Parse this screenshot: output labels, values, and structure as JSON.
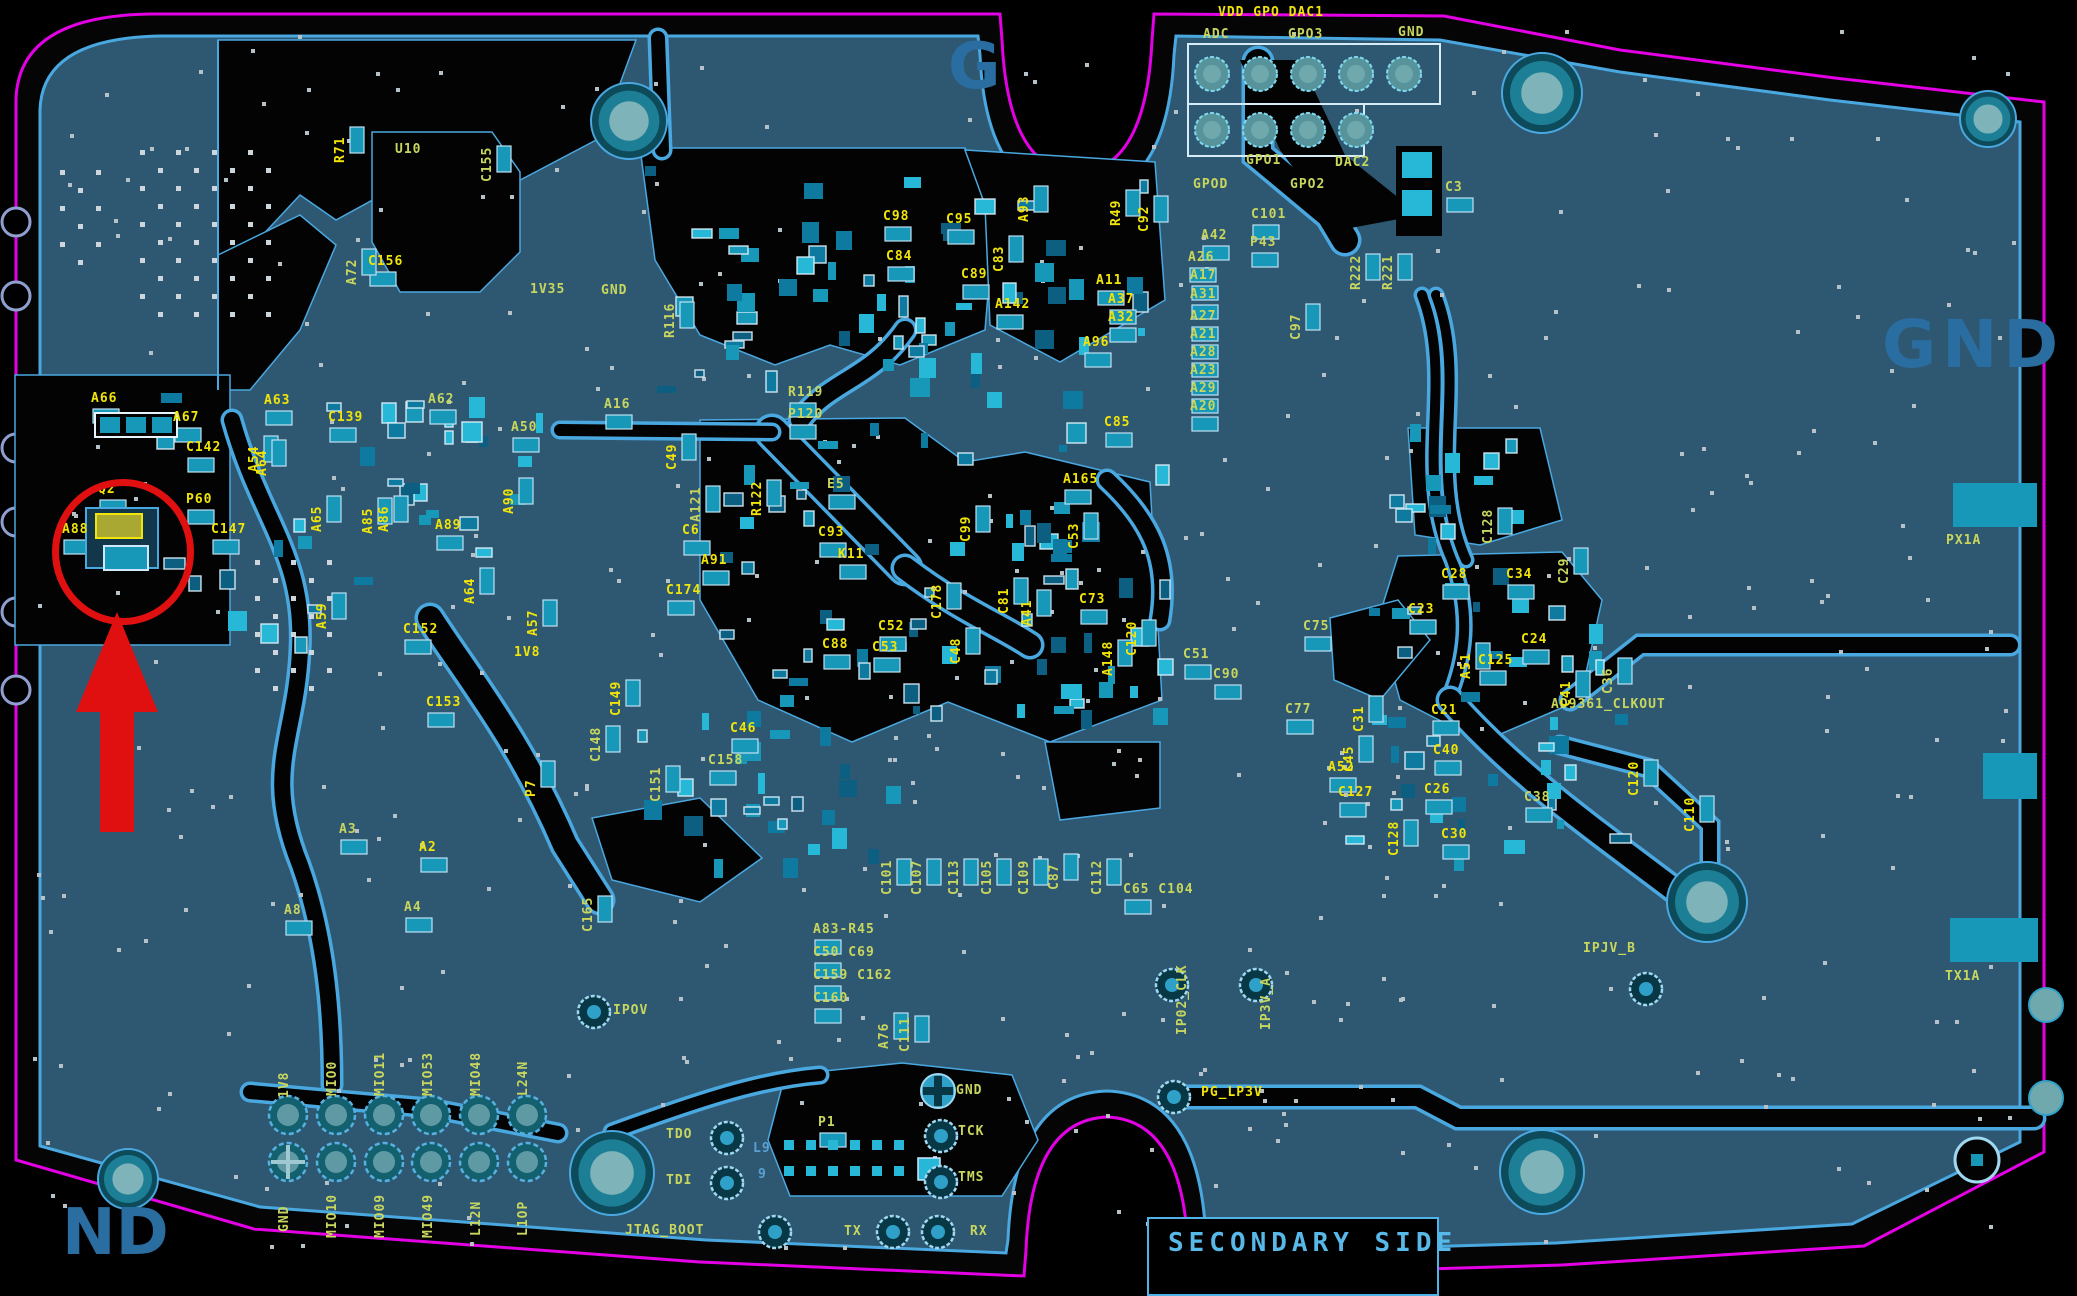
{
  "big_texts": {
    "g_top": "G",
    "gnd_right": "GND",
    "nd_bottom_left": "ND",
    "secondary_side": "SECONDARY SIDE"
  },
  "colors": {
    "board": "#2e5872",
    "outline_magenta": "#e400e4",
    "edge_blue": "#4aa8e0",
    "silk_green": "#c9d65e",
    "silk_yellow": "#f0e40a",
    "big_text_blue": "#2a6da0",
    "pad_teal": "#1898b8",
    "highlight_red": "#e01010"
  },
  "labels": [
    {
      "t": "VDD GPO DAC1",
      "x": 1218,
      "y": 6,
      "o": "h",
      "c": "y"
    },
    {
      "t": "ADC",
      "x": 1203,
      "y": 28,
      "o": "h",
      "c": "g"
    },
    {
      "t": "GPO3",
      "x": 1288,
      "y": 28,
      "o": "h",
      "c": "g"
    },
    {
      "t": "GND",
      "x": 1398,
      "y": 26,
      "o": "h",
      "c": "g"
    },
    {
      "t": "GPO1",
      "x": 1246,
      "y": 154,
      "o": "h",
      "c": "g"
    },
    {
      "t": "DAC2",
      "x": 1335,
      "y": 156,
      "o": "h",
      "c": "g"
    },
    {
      "t": "GPOD",
      "x": 1193,
      "y": 178,
      "o": "h",
      "c": "g"
    },
    {
      "t": "GPO2",
      "x": 1290,
      "y": 178,
      "o": "h",
      "c": "g"
    },
    {
      "t": "C3",
      "x": 1445,
      "y": 181,
      "o": "h",
      "c": "g"
    },
    {
      "t": "C101",
      "x": 1251,
      "y": 208,
      "o": "h",
      "c": "g"
    },
    {
      "t": "A42",
      "x": 1201,
      "y": 229,
      "o": "h",
      "c": "g"
    },
    {
      "t": "P43",
      "x": 1250,
      "y": 236,
      "o": "h",
      "c": "g"
    },
    {
      "t": "A26",
      "x": 1188,
      "y": 251,
      "o": "h",
      "c": "g"
    },
    {
      "t": "A17",
      "x": 1190,
      "y": 269,
      "o": "h",
      "c": "g"
    },
    {
      "t": "A31",
      "x": 1190,
      "y": 288,
      "o": "h",
      "c": "g"
    },
    {
      "t": "A27",
      "x": 1190,
      "y": 310,
      "o": "h",
      "c": "g"
    },
    {
      "t": "A21",
      "x": 1190,
      "y": 328,
      "o": "h",
      "c": "g"
    },
    {
      "t": "A28",
      "x": 1190,
      "y": 346,
      "o": "h",
      "c": "g"
    },
    {
      "t": "A23",
      "x": 1190,
      "y": 364,
      "o": "h",
      "c": "g"
    },
    {
      "t": "A29",
      "x": 1190,
      "y": 382,
      "o": "h",
      "c": "g"
    },
    {
      "t": "A20",
      "x": 1190,
      "y": 400,
      "o": "h",
      "c": "g"
    },
    {
      "t": "C98",
      "x": 883,
      "y": 210,
      "o": "h",
      "c": "y"
    },
    {
      "t": "C95",
      "x": 946,
      "y": 213,
      "o": "h",
      "c": "y"
    },
    {
      "t": "C84",
      "x": 886,
      "y": 250,
      "o": "h",
      "c": "y"
    },
    {
      "t": "C89",
      "x": 961,
      "y": 268,
      "o": "h",
      "c": "y"
    },
    {
      "t": "A142",
      "x": 995,
      "y": 298,
      "o": "h",
      "c": "y"
    },
    {
      "t": "A11",
      "x": 1096,
      "y": 274,
      "o": "h",
      "c": "y"
    },
    {
      "t": "A37",
      "x": 1108,
      "y": 293,
      "o": "h",
      "c": "y"
    },
    {
      "t": "A32",
      "x": 1108,
      "y": 311,
      "o": "h",
      "c": "y"
    },
    {
      "t": "A96",
      "x": 1083,
      "y": 336,
      "o": "h",
      "c": "y"
    },
    {
      "t": "C85",
      "x": 1104,
      "y": 416,
      "o": "h",
      "c": "y"
    },
    {
      "t": "1V35",
      "x": 530,
      "y": 283,
      "o": "h",
      "c": "g"
    },
    {
      "t": "GND",
      "x": 601,
      "y": 284,
      "o": "h",
      "c": "g"
    },
    {
      "t": "A16",
      "x": 604,
      "y": 398,
      "o": "h",
      "c": "g"
    },
    {
      "t": "R119",
      "x": 788,
      "y": 386,
      "o": "h",
      "c": "g"
    },
    {
      "t": "P120",
      "x": 788,
      "y": 408,
      "o": "h",
      "c": "g"
    },
    {
      "t": "A50",
      "x": 511,
      "y": 421,
      "o": "h",
      "c": "g"
    },
    {
      "t": "C139",
      "x": 328,
      "y": 411,
      "o": "h",
      "c": "y"
    },
    {
      "t": "A62",
      "x": 428,
      "y": 393,
      "o": "h",
      "c": "g"
    },
    {
      "t": "A63",
      "x": 264,
      "y": 394,
      "o": "h",
      "c": "y"
    },
    {
      "t": "A66",
      "x": 91,
      "y": 392,
      "o": "h",
      "c": "y"
    },
    {
      "t": "A67",
      "x": 173,
      "y": 411,
      "o": "h",
      "c": "y"
    },
    {
      "t": "C142",
      "x": 186,
      "y": 441,
      "o": "h",
      "c": "y"
    },
    {
      "t": "Q2",
      "x": 98,
      "y": 483,
      "o": "h",
      "c": "y"
    },
    {
      "t": "P60",
      "x": 186,
      "y": 493,
      "o": "h",
      "c": "y"
    },
    {
      "t": "A88",
      "x": 62,
      "y": 523,
      "o": "h",
      "c": "y"
    },
    {
      "t": "C147",
      "x": 211,
      "y": 523,
      "o": "h",
      "c": "y"
    },
    {
      "t": "A89",
      "x": 435,
      "y": 519,
      "o": "h",
      "c": "y"
    },
    {
      "t": "E5",
      "x": 827,
      "y": 478,
      "o": "h",
      "c": "g"
    },
    {
      "t": "C6",
      "x": 682,
      "y": 524,
      "o": "h",
      "c": "y"
    },
    {
      "t": "C93",
      "x": 818,
      "y": 526,
      "o": "h",
      "c": "y"
    },
    {
      "t": "K11",
      "x": 838,
      "y": 548,
      "o": "h",
      "c": "y"
    },
    {
      "t": "A91",
      "x": 701,
      "y": 554,
      "o": "h",
      "c": "y"
    },
    {
      "t": "C174",
      "x": 666,
      "y": 584,
      "o": "h",
      "c": "y"
    },
    {
      "t": "C73",
      "x": 1079,
      "y": 593,
      "o": "h",
      "c": "y"
    },
    {
      "t": "C75",
      "x": 1303,
      "y": 620,
      "o": "h",
      "c": "g"
    },
    {
      "t": "C23",
      "x": 1408,
      "y": 603,
      "o": "h",
      "c": "y"
    },
    {
      "t": "C28",
      "x": 1441,
      "y": 568,
      "o": "h",
      "c": "y"
    },
    {
      "t": "C34",
      "x": 1506,
      "y": 568,
      "o": "h",
      "c": "y"
    },
    {
      "t": "C24",
      "x": 1521,
      "y": 633,
      "o": "h",
      "c": "y"
    },
    {
      "t": "C51",
      "x": 1183,
      "y": 648,
      "o": "h",
      "c": "g"
    },
    {
      "t": "C90",
      "x": 1213,
      "y": 668,
      "o": "h",
      "c": "g"
    },
    {
      "t": "C77",
      "x": 1285,
      "y": 703,
      "o": "h",
      "c": "g"
    },
    {
      "t": "C52",
      "x": 878,
      "y": 620,
      "o": "h",
      "c": "y"
    },
    {
      "t": "C53",
      "x": 872,
      "y": 641,
      "o": "h",
      "c": "y"
    },
    {
      "t": "C88",
      "x": 822,
      "y": 638,
      "o": "h",
      "c": "y"
    },
    {
      "t": "C21",
      "x": 1431,
      "y": 704,
      "o": "h",
      "c": "y"
    },
    {
      "t": "C40",
      "x": 1433,
      "y": 744,
      "o": "h",
      "c": "y"
    },
    {
      "t": "C26",
      "x": 1424,
      "y": 783,
      "o": "h",
      "c": "y"
    },
    {
      "t": "C38",
      "x": 1524,
      "y": 791,
      "o": "h",
      "c": "g"
    },
    {
      "t": "C30",
      "x": 1441,
      "y": 828,
      "o": "h",
      "c": "y"
    },
    {
      "t": "C125",
      "x": 1478,
      "y": 654,
      "o": "h",
      "c": "y"
    },
    {
      "t": "AD9361_CLKOUT",
      "x": 1551,
      "y": 698,
      "o": "h",
      "c": "g"
    },
    {
      "t": "A52",
      "x": 1328,
      "y": 761,
      "o": "h",
      "c": "y"
    },
    {
      "t": "C127",
      "x": 1338,
      "y": 786,
      "o": "h",
      "c": "y"
    },
    {
      "t": "C152",
      "x": 403,
      "y": 623,
      "o": "h",
      "c": "y"
    },
    {
      "t": "C153",
      "x": 426,
      "y": 696,
      "o": "h",
      "c": "y"
    },
    {
      "t": "1V8",
      "x": 514,
      "y": 646,
      "o": "h",
      "c": "y"
    },
    {
      "t": "A3",
      "x": 339,
      "y": 823,
      "o": "h",
      "c": "g"
    },
    {
      "t": "A2",
      "x": 419,
      "y": 841,
      "o": "h",
      "c": "y"
    },
    {
      "t": "A8",
      "x": 284,
      "y": 904,
      "o": "h",
      "c": "g"
    },
    {
      "t": "A4",
      "x": 404,
      "y": 901,
      "o": "h",
      "c": "g"
    },
    {
      "t": "C158",
      "x": 708,
      "y": 754,
      "o": "h",
      "c": "g"
    },
    {
      "t": "C46",
      "x": 730,
      "y": 722,
      "o": "h",
      "c": "y"
    },
    {
      "t": "A83-R45",
      "x": 813,
      "y": 923,
      "o": "h",
      "c": "g"
    },
    {
      "t": "C50 C69",
      "x": 813,
      "y": 946,
      "o": "h",
      "c": "g"
    },
    {
      "t": "C159 C162",
      "x": 813,
      "y": 969,
      "o": "h",
      "c": "g"
    },
    {
      "t": "C160",
      "x": 813,
      "y": 992,
      "o": "h",
      "c": "g"
    },
    {
      "t": "C65 C104",
      "x": 1123,
      "y": 883,
      "o": "h",
      "c": "g"
    },
    {
      "t": "GND",
      "x": 956,
      "y": 1084,
      "o": "h",
      "c": "g"
    },
    {
      "t": "TCK",
      "x": 958,
      "y": 1125,
      "o": "h",
      "c": "g"
    },
    {
      "t": "TMS",
      "x": 958,
      "y": 1171,
      "o": "h",
      "c": "g"
    },
    {
      "t": "TDO",
      "x": 666,
      "y": 1128,
      "o": "h",
      "c": "g"
    },
    {
      "t": "TDI",
      "x": 666,
      "y": 1174,
      "o": "h",
      "c": "g"
    },
    {
      "t": "L9",
      "x": 753,
      "y": 1142,
      "o": "h",
      "c": "b"
    },
    {
      "t": "9",
      "x": 758,
      "y": 1168,
      "o": "h",
      "c": "b"
    },
    {
      "t": "P1",
      "x": 818,
      "y": 1116,
      "o": "h",
      "c": "g"
    },
    {
      "t": "JTAG_BOOT",
      "x": 625,
      "y": 1224,
      "o": "h",
      "c": "g"
    },
    {
      "t": "TX",
      "x": 844,
      "y": 1225,
      "o": "h",
      "c": "g"
    },
    {
      "t": "RX",
      "x": 970,
      "y": 1225,
      "o": "h",
      "c": "g"
    },
    {
      "t": "IPOV",
      "x": 613,
      "y": 1004,
      "o": "h",
      "c": "g"
    },
    {
      "t": "PG_LP3V",
      "x": 1201,
      "y": 1086,
      "o": "h",
      "c": "y"
    },
    {
      "t": "IPJV_B",
      "x": 1583,
      "y": 942,
      "o": "h",
      "c": "g"
    },
    {
      "t": "PX1A",
      "x": 1946,
      "y": 534,
      "o": "h",
      "c": "g"
    },
    {
      "t": "TX1A",
      "x": 1945,
      "y": 970,
      "o": "h",
      "c": "g"
    },
    {
      "t": "U10",
      "x": 395,
      "y": 143,
      "o": "h",
      "c": "g"
    },
    {
      "t": "C156",
      "x": 368,
      "y": 255,
      "o": "h",
      "c": "y"
    },
    {
      "t": "A165",
      "x": 1063,
      "y": 473,
      "o": "h",
      "c": "y"
    },
    {
      "t": "R71",
      "x": 334,
      "y": 163,
      "o": "v",
      "c": "y"
    },
    {
      "t": "A72",
      "x": 346,
      "y": 285,
      "o": "v",
      "c": "g"
    },
    {
      "t": "C155",
      "x": 481,
      "y": 182,
      "o": "v",
      "c": "g"
    },
    {
      "t": "R116",
      "x": 664,
      "y": 338,
      "o": "v",
      "c": "g"
    },
    {
      "t": "C49",
      "x": 666,
      "y": 470,
      "o": "v",
      "c": "y"
    },
    {
      "t": "A121",
      "x": 690,
      "y": 522,
      "o": "v",
      "c": "g"
    },
    {
      "t": "R122",
      "x": 751,
      "y": 516,
      "o": "v",
      "c": "y"
    },
    {
      "t": "A90",
      "x": 503,
      "y": 514,
      "o": "v",
      "c": "y"
    },
    {
      "t": "A85",
      "x": 362,
      "y": 534,
      "o": "v",
      "c": "y"
    },
    {
      "t": "A86",
      "x": 378,
      "y": 532,
      "o": "v",
      "c": "y"
    },
    {
      "t": "A65",
      "x": 311,
      "y": 532,
      "o": "v",
      "c": "y"
    },
    {
      "t": "A54",
      "x": 248,
      "y": 472,
      "o": "v",
      "c": "y"
    },
    {
      "t": "A64",
      "x": 256,
      "y": 476,
      "o": "v",
      "c": "y"
    },
    {
      "t": "A64",
      "x": 464,
      "y": 604,
      "o": "v",
      "c": "y"
    },
    {
      "t": "A59",
      "x": 316,
      "y": 629,
      "o": "v",
      "c": "y"
    },
    {
      "t": "A57",
      "x": 527,
      "y": 636,
      "o": "v",
      "c": "y"
    },
    {
      "t": "P7",
      "x": 525,
      "y": 797,
      "o": "v",
      "c": "y"
    },
    {
      "t": "C148",
      "x": 590,
      "y": 762,
      "o": "v",
      "c": "g"
    },
    {
      "t": "C149",
      "x": 610,
      "y": 716,
      "o": "v",
      "c": "y"
    },
    {
      "t": "C151",
      "x": 650,
      "y": 802,
      "o": "v",
      "c": "g"
    },
    {
      "t": "C165",
      "x": 582,
      "y": 932,
      "o": "v",
      "c": "g"
    },
    {
      "t": "A76",
      "x": 878,
      "y": 1049,
      "o": "v",
      "c": "g"
    },
    {
      "t": "C111",
      "x": 899,
      "y": 1052,
      "o": "v",
      "c": "g"
    },
    {
      "t": "C101",
      "x": 881,
      "y": 895,
      "o": "v",
      "c": "g"
    },
    {
      "t": "C107",
      "x": 911,
      "y": 895,
      "o": "v",
      "c": "g"
    },
    {
      "t": "C113",
      "x": 948,
      "y": 895,
      "o": "v",
      "c": "g"
    },
    {
      "t": "C105",
      "x": 981,
      "y": 895,
      "o": "v",
      "c": "g"
    },
    {
      "t": "C109",
      "x": 1018,
      "y": 895,
      "o": "v",
      "c": "g"
    },
    {
      "t": "C87",
      "x": 1048,
      "y": 890,
      "o": "v",
      "c": "g"
    },
    {
      "t": "C112",
      "x": 1091,
      "y": 895,
      "o": "v",
      "c": "g"
    },
    {
      "t": "IP02_CLK",
      "x": 1176,
      "y": 1035,
      "o": "v",
      "c": "g"
    },
    {
      "t": "IP3V_A",
      "x": 1260,
      "y": 1030,
      "o": "v",
      "c": "g"
    },
    {
      "t": "R222",
      "x": 1350,
      "y": 290,
      "o": "v",
      "c": "g"
    },
    {
      "t": "R221",
      "x": 1382,
      "y": 290,
      "o": "v",
      "c": "g"
    },
    {
      "t": "C97",
      "x": 1290,
      "y": 340,
      "o": "v",
      "c": "g"
    },
    {
      "t": "R49",
      "x": 1110,
      "y": 226,
      "o": "v",
      "c": "y"
    },
    {
      "t": "C92",
      "x": 1138,
      "y": 232,
      "o": "v",
      "c": "y"
    },
    {
      "t": "A93",
      "x": 1018,
      "y": 222,
      "o": "v",
      "c": "y"
    },
    {
      "t": "C83",
      "x": 993,
      "y": 272,
      "o": "v",
      "c": "y"
    },
    {
      "t": "C99",
      "x": 960,
      "y": 542,
      "o": "v",
      "c": "y"
    },
    {
      "t": "C178",
      "x": 931,
      "y": 619,
      "o": "v",
      "c": "y"
    },
    {
      "t": "C81",
      "x": 998,
      "y": 614,
      "o": "v",
      "c": "y"
    },
    {
      "t": "A41",
      "x": 1021,
      "y": 626,
      "o": "v",
      "c": "y"
    },
    {
      "t": "C53",
      "x": 1068,
      "y": 549,
      "o": "v",
      "c": "y"
    },
    {
      "t": "C120",
      "x": 1126,
      "y": 656,
      "o": "v",
      "c": "y"
    },
    {
      "t": "A148",
      "x": 1102,
      "y": 676,
      "o": "v",
      "c": "y"
    },
    {
      "t": "C48",
      "x": 950,
      "y": 664,
      "o": "v",
      "c": "y"
    },
    {
      "t": "C128",
      "x": 1482,
      "y": 544,
      "o": "v",
      "c": "g"
    },
    {
      "t": "C29",
      "x": 1558,
      "y": 584,
      "o": "v",
      "c": "g"
    },
    {
      "t": "A51",
      "x": 1460,
      "y": 679,
      "o": "v",
      "c": "y"
    },
    {
      "t": "C31",
      "x": 1353,
      "y": 732,
      "o": "v",
      "c": "y"
    },
    {
      "t": "C45",
      "x": 1343,
      "y": 772,
      "o": "v",
      "c": "y"
    },
    {
      "t": "C36",
      "x": 1602,
      "y": 694,
      "o": "v",
      "c": "g"
    },
    {
      "t": "C41",
      "x": 1560,
      "y": 707,
      "o": "v",
      "c": "y"
    },
    {
      "t": "C120",
      "x": 1628,
      "y": 796,
      "o": "v",
      "c": "y"
    },
    {
      "t": "C110",
      "x": 1684,
      "y": 832,
      "o": "v",
      "c": "y"
    },
    {
      "t": "C128",
      "x": 1388,
      "y": 856,
      "o": "v",
      "c": "y"
    },
    {
      "t": "1V8",
      "x": 278,
      "y": 1098,
      "o": "v",
      "c": "g"
    },
    {
      "t": "MIO0",
      "x": 326,
      "y": 1096,
      "o": "v",
      "c": "g"
    },
    {
      "t": "MIO11",
      "x": 374,
      "y": 1096,
      "o": "v",
      "c": "g"
    },
    {
      "t": "MIO53",
      "x": 422,
      "y": 1096,
      "o": "v",
      "c": "g"
    },
    {
      "t": "MIO48",
      "x": 470,
      "y": 1096,
      "o": "v",
      "c": "g"
    },
    {
      "t": "L24N",
      "x": 517,
      "y": 1096,
      "o": "v",
      "c": "g"
    },
    {
      "t": "GND",
      "x": 278,
      "y": 1232,
      "o": "v",
      "c": "g"
    },
    {
      "t": "MIO10",
      "x": 326,
      "y": 1238,
      "o": "v",
      "c": "g"
    },
    {
      "t": "MIO09",
      "x": 374,
      "y": 1238,
      "o": "v",
      "c": "g"
    },
    {
      "t": "MIO49",
      "x": 422,
      "y": 1238,
      "o": "v",
      "c": "g"
    },
    {
      "t": "L12N",
      "x": 470,
      "y": 1236,
      "o": "v",
      "c": "g"
    },
    {
      "t": "L1OP",
      "x": 517,
      "y": 1236,
      "o": "v",
      "c": "g"
    }
  ],
  "annotations": {
    "circle": {
      "cx": 116,
      "cy": 545,
      "rx": 64,
      "ry": 66
    },
    "arrow": {
      "tip_x": 117,
      "tip_y": 612,
      "base_y": 712,
      "half_head": 41,
      "shaft_half": 17,
      "tail_y": 834
    }
  }
}
